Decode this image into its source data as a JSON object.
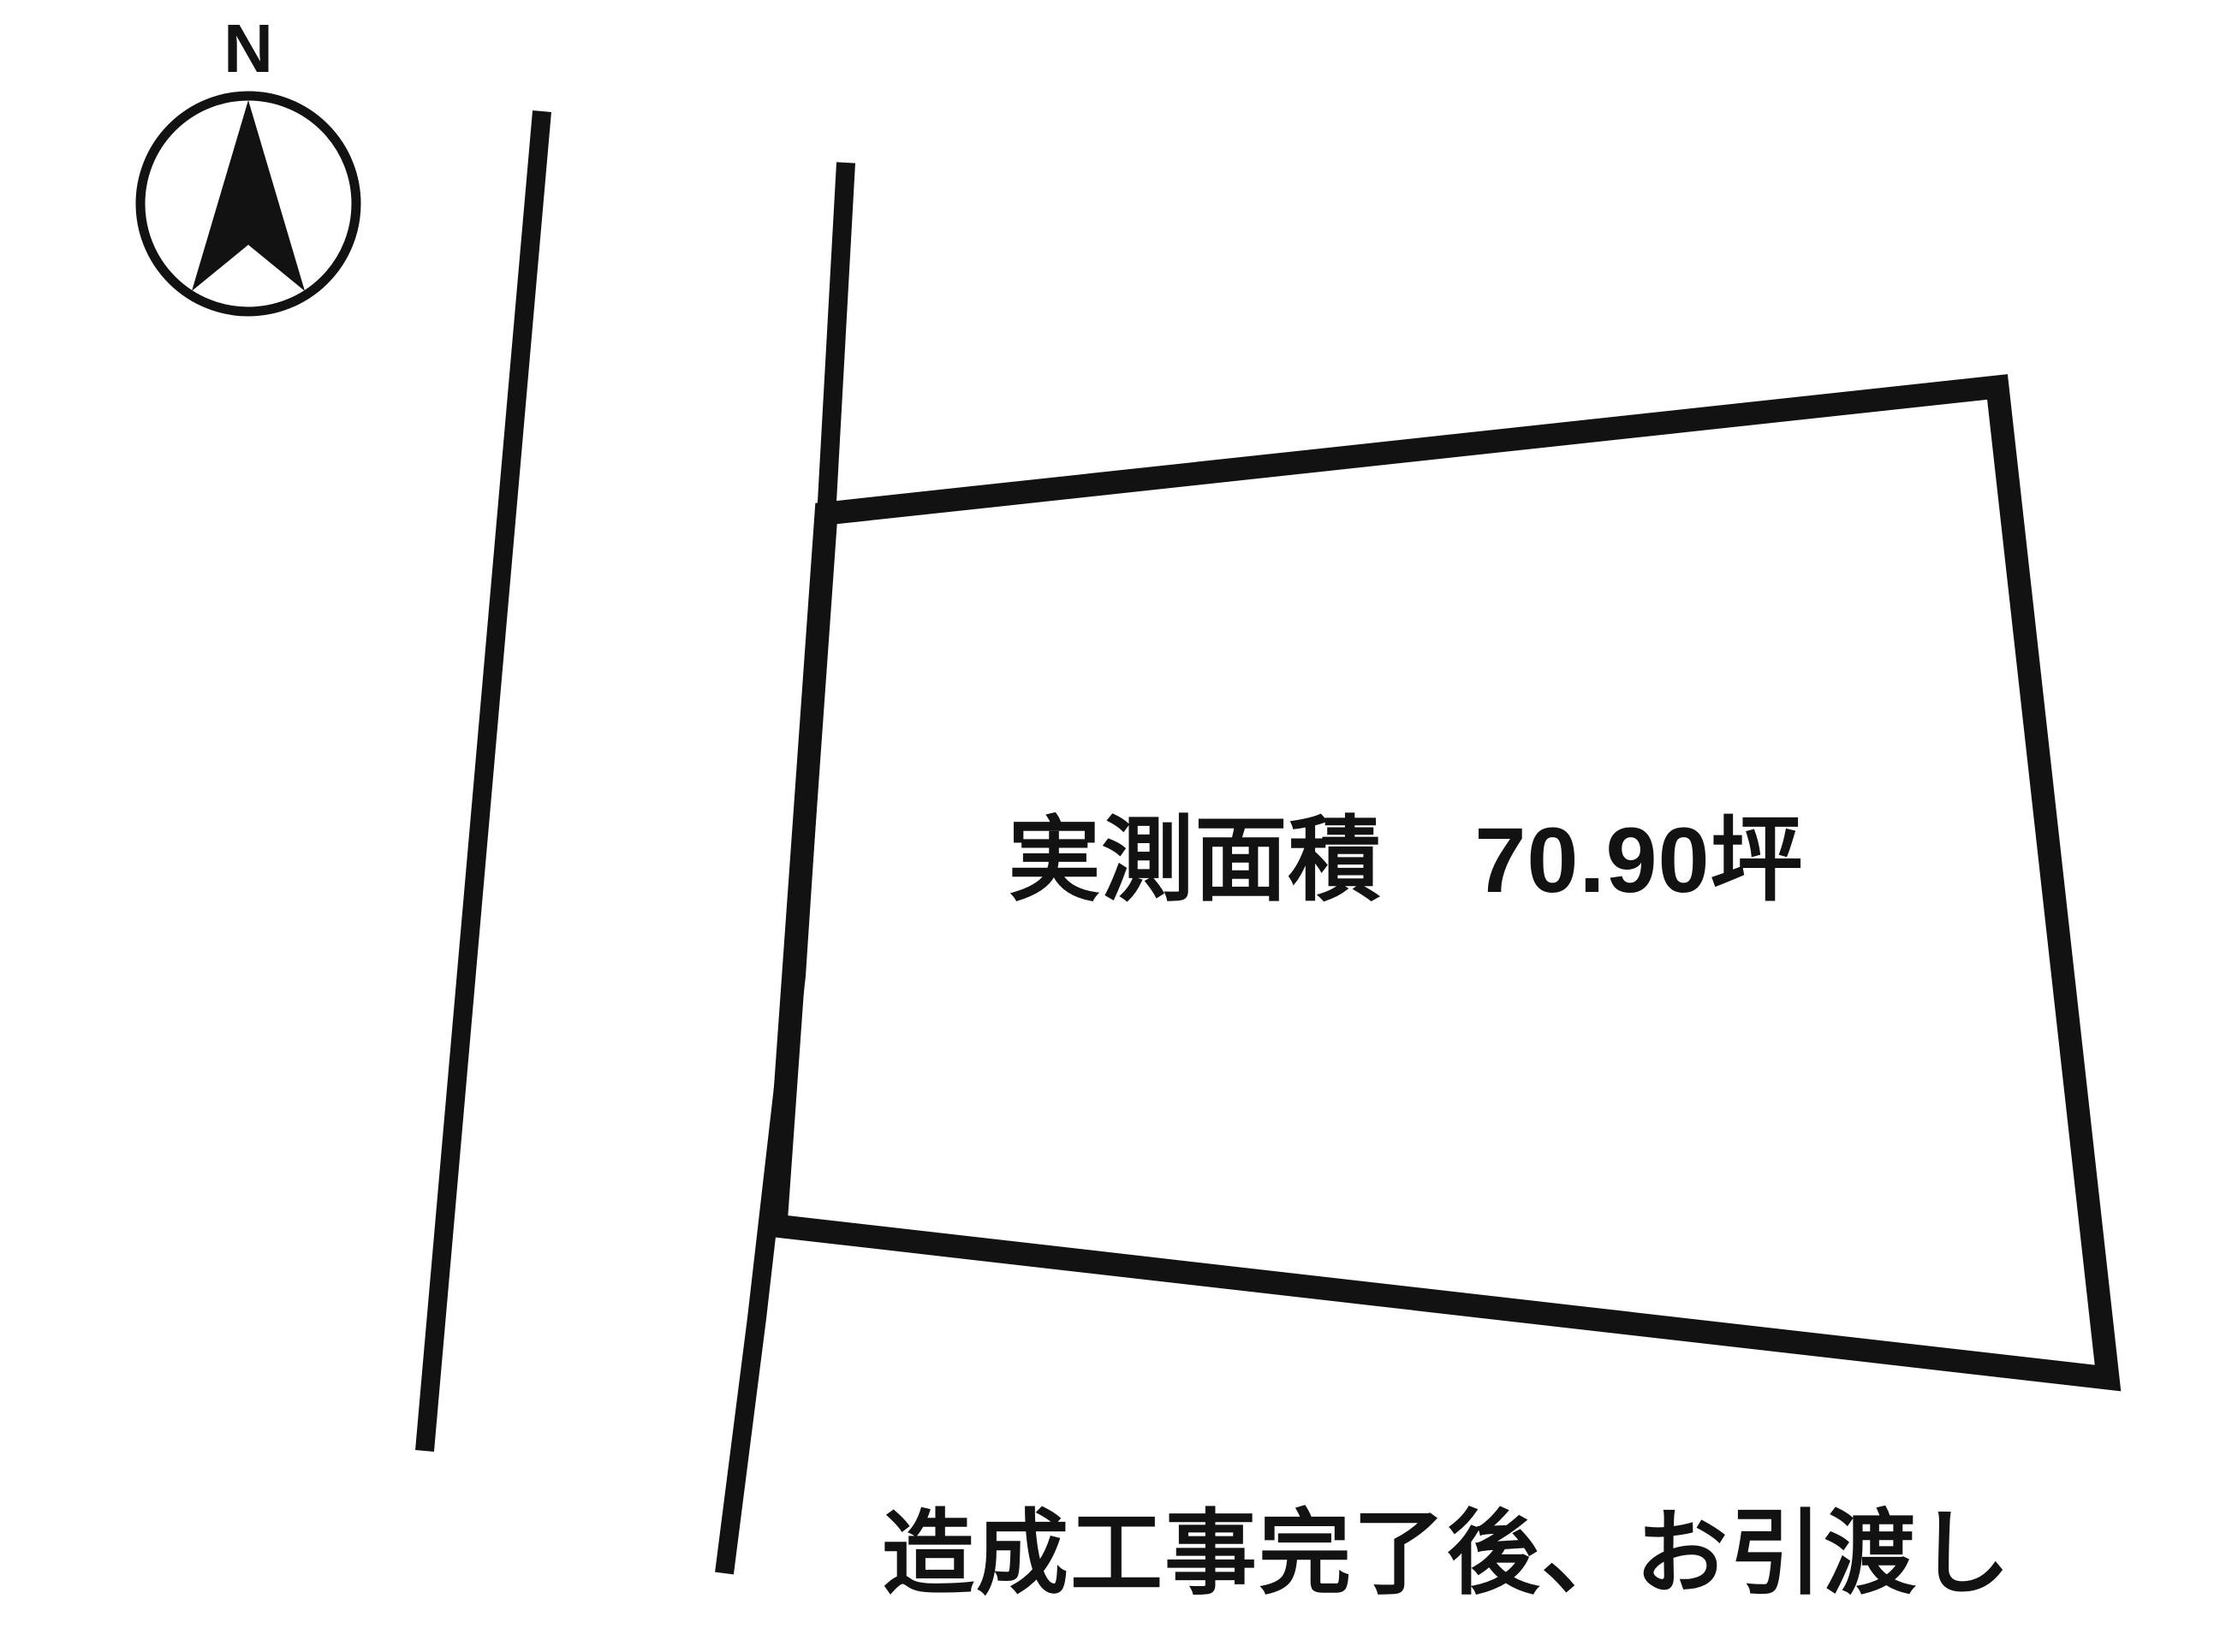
{
  "colors": {
    "background": "#ffffff",
    "ink": "#121212"
  },
  "compass": {
    "north_label": "N",
    "needle_points": "290,117 356,340 290,286 224,340"
  },
  "roads": {
    "left_points": "633,130 496,1695",
    "right_points": "988,190 963,640 930,1140 884,1540 846,1838"
  },
  "plot": {
    "outline_points": "965,600 2333,452 2462,1610 906,1432",
    "area_label": "実測面積　70.90坪"
  },
  "note": {
    "text": "造成工事完了後、お引渡し"
  }
}
